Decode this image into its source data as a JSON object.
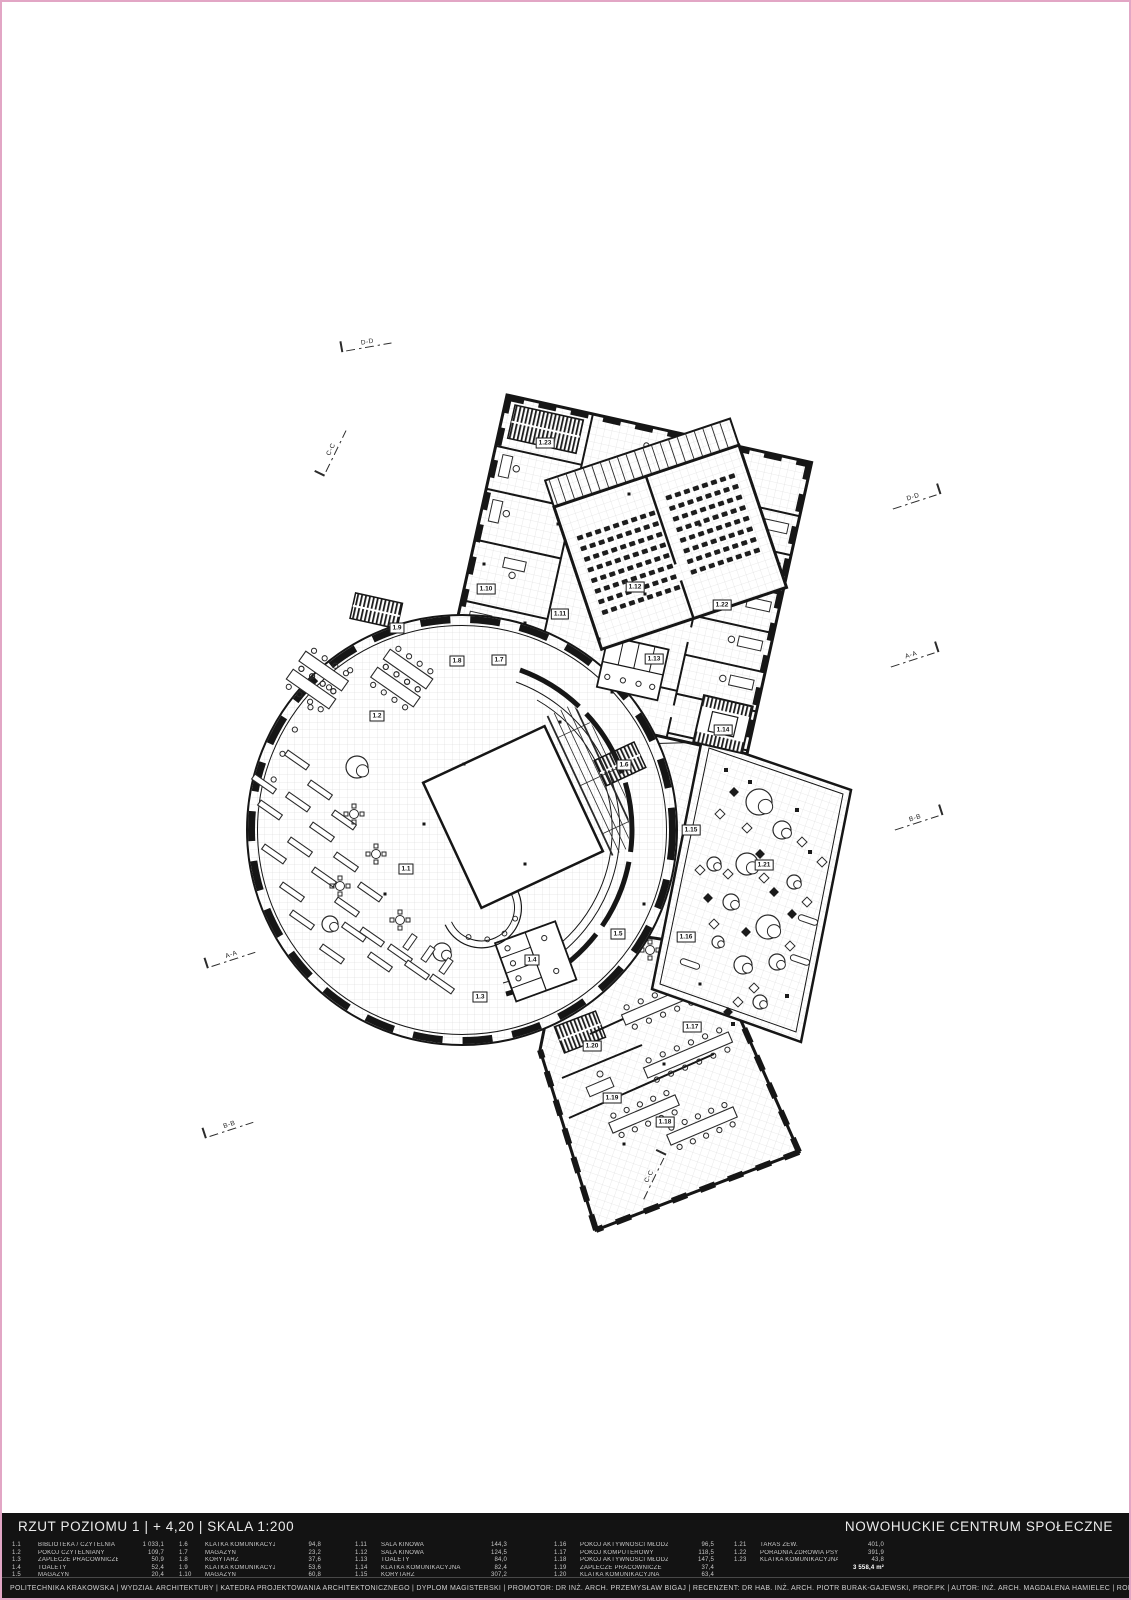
{
  "titlebar": {
    "left": "RZUT POZIOMU 1 | + 4,20 | SKALA 1:200",
    "right": "NOWOHUCKIE CENTRUM SPOŁECZNE"
  },
  "credits": "POLITECHNIKA KRAKOWSKA | WYDZIAŁ ARCHITEKTURY | KATEDRA PROJEKTOWANIA ARCHITEKTONICZNEGO | DYPLOM MAGISTERSKI | PROMOTOR: DR INŻ. ARCH. PRZEMYSŁAW BIGAJ | RECENZENT: DR HAB. INŻ. ARCH. PIOTR BURAK-GAJEWSKI, PROF.PK | AUTOR: INŻ. ARCH. MAGDALENA HAMIELEC | ROK: 2023/24",
  "legend": {
    "total_label": "3 558,4 m²",
    "columns": [
      {
        "entries": [
          {
            "id": "1.1",
            "name": "BIBLIOTEKA / CZYTELNIA",
            "area": "1 033,1"
          },
          {
            "id": "1.2",
            "name": "POKÓJ CZYTELNIANY",
            "area": "109,7"
          },
          {
            "id": "1.3",
            "name": "ZAPLECZE PRACOWNICZE",
            "area": "50,9"
          },
          {
            "id": "1.4",
            "name": "TOALETY",
            "area": "52,4"
          },
          {
            "id": "1.5",
            "name": "MAGAZYN",
            "area": "20,4"
          }
        ]
      },
      {
        "entries": [
          {
            "id": "1.6",
            "name": "KLATKA KOMUNIKACYJNA",
            "area": "94,8"
          },
          {
            "id": "1.7",
            "name": "MAGAZYN",
            "area": "23,2"
          },
          {
            "id": "1.8",
            "name": "KORYTARZ",
            "area": "37,6"
          },
          {
            "id": "1.9",
            "name": "KLATKA KOMUNIKACYJNA",
            "area": "53,6"
          },
          {
            "id": "1.10",
            "name": "MAGAZYN",
            "area": "60,8"
          }
        ]
      },
      {
        "entries": [
          {
            "id": "1.11",
            "name": "SALA KINOWA",
            "area": "144,3"
          },
          {
            "id": "1.12",
            "name": "SALA KINOWA",
            "area": "124,5"
          },
          {
            "id": "1.13",
            "name": "TOALETY",
            "area": "84,0"
          },
          {
            "id": "1.14",
            "name": "KLATKA KOMUNIKACYJNA",
            "area": "82,4"
          },
          {
            "id": "1.15",
            "name": "KORYTARZ",
            "area": "307,2"
          }
        ]
      },
      {
        "entries": [
          {
            "id": "1.16",
            "name": "POKÓJ AKTYWNOŚCI MŁODZIEŻY",
            "area": "96,5"
          },
          {
            "id": "1.17",
            "name": "POKÓJ KOMPUTEROWY",
            "area": "118,5"
          },
          {
            "id": "1.18",
            "name": "POKÓJ AKTYWNOŚCI MŁODZIEŻY",
            "area": "147,5"
          },
          {
            "id": "1.19",
            "name": "ZAPLECZE PRACOWNICZE",
            "area": "37,4"
          },
          {
            "id": "1.20",
            "name": "KLATKA KOMUNIKACYJNA",
            "area": "63,4"
          }
        ]
      },
      {
        "entries": [
          {
            "id": "1.21",
            "name": "TARAS ZEW.",
            "area": "401,0"
          },
          {
            "id": "1.22",
            "name": "PORADNIA ZDROWIA PSYCHICZNEGO",
            "area": "391,9"
          },
          {
            "id": "1.23",
            "name": "KLATKA KOMUNIKACYJNA",
            "area": "43,8"
          }
        ]
      }
    ]
  },
  "plan": {
    "room_labels": [
      {
        "id": "1.1",
        "x": 404,
        "y": 867
      },
      {
        "id": "1.2",
        "x": 375,
        "y": 714
      },
      {
        "id": "1.3",
        "x": 478,
        "y": 995
      },
      {
        "id": "1.4",
        "x": 530,
        "y": 958
      },
      {
        "id": "1.5",
        "x": 616,
        "y": 932
      },
      {
        "id": "1.6",
        "x": 622,
        "y": 763
      },
      {
        "id": "1.7",
        "x": 497,
        "y": 658
      },
      {
        "id": "1.8",
        "x": 455,
        "y": 659
      },
      {
        "id": "1.9",
        "x": 395,
        "y": 626
      },
      {
        "id": "1.10",
        "x": 484,
        "y": 587
      },
      {
        "id": "1.11",
        "x": 558,
        "y": 612
      },
      {
        "id": "1.12",
        "x": 633,
        "y": 585
      },
      {
        "id": "1.13",
        "x": 652,
        "y": 657
      },
      {
        "id": "1.14",
        "x": 721,
        "y": 728
      },
      {
        "id": "1.15",
        "x": 689,
        "y": 828
      },
      {
        "id": "1.16",
        "x": 684,
        "y": 935
      },
      {
        "id": "1.17",
        "x": 690,
        "y": 1025
      },
      {
        "id": "1.18",
        "x": 663,
        "y": 1120
      },
      {
        "id": "1.19",
        "x": 610,
        "y": 1096
      },
      {
        "id": "1.20",
        "x": 590,
        "y": 1044
      },
      {
        "id": "1.21",
        "x": 762,
        "y": 863
      },
      {
        "id": "1.22",
        "x": 720,
        "y": 603
      },
      {
        "id": "1.23",
        "x": 543,
        "y": 441
      }
    ],
    "section_markers": [
      {
        "label": "D-D",
        "x": 368,
        "y": 343,
        "angle": -10,
        "side": "l"
      },
      {
        "label": "C-C",
        "x": 333,
        "y": 452,
        "angle": -64,
        "side": "l"
      },
      {
        "label": "D-D",
        "x": 918,
        "y": 497,
        "angle": -18,
        "side": "r"
      },
      {
        "label": "A-A",
        "x": 916,
        "y": 655,
        "angle": -18,
        "side": "r"
      },
      {
        "label": "B-B",
        "x": 920,
        "y": 818,
        "angle": -18,
        "side": "r"
      },
      {
        "label": "A-A",
        "x": 232,
        "y": 956,
        "angle": -18,
        "side": "l"
      },
      {
        "label": "B-B",
        "x": 230,
        "y": 1126,
        "angle": -18,
        "side": "l"
      },
      {
        "label": "C-C",
        "x": 653,
        "y": 1175,
        "angle": -64,
        "side": "r"
      }
    ]
  }
}
